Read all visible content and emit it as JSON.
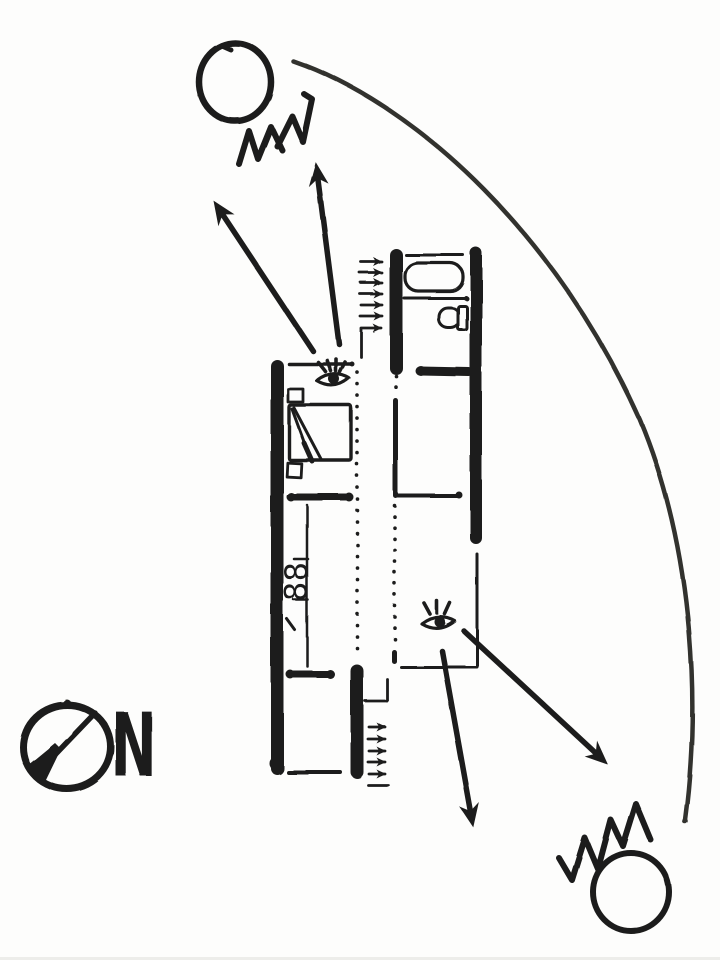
{
  "colors": {
    "ink": "#1d1d1b",
    "arc_ink": "#33332f",
    "paper": "#fdfdfc"
  },
  "compass": {
    "label": "N"
  },
  "floor_plan": {
    "cooktop_label": "88"
  },
  "icons": {
    "sun_top": "sun-icon",
    "sun_bottom": "sun-icon",
    "eye_bedroom": "eye-view-icon",
    "eye_living": "eye-view-icon",
    "compass_north": "north-arrow-icon",
    "stairs_up": "stair-direction-arrows"
  }
}
